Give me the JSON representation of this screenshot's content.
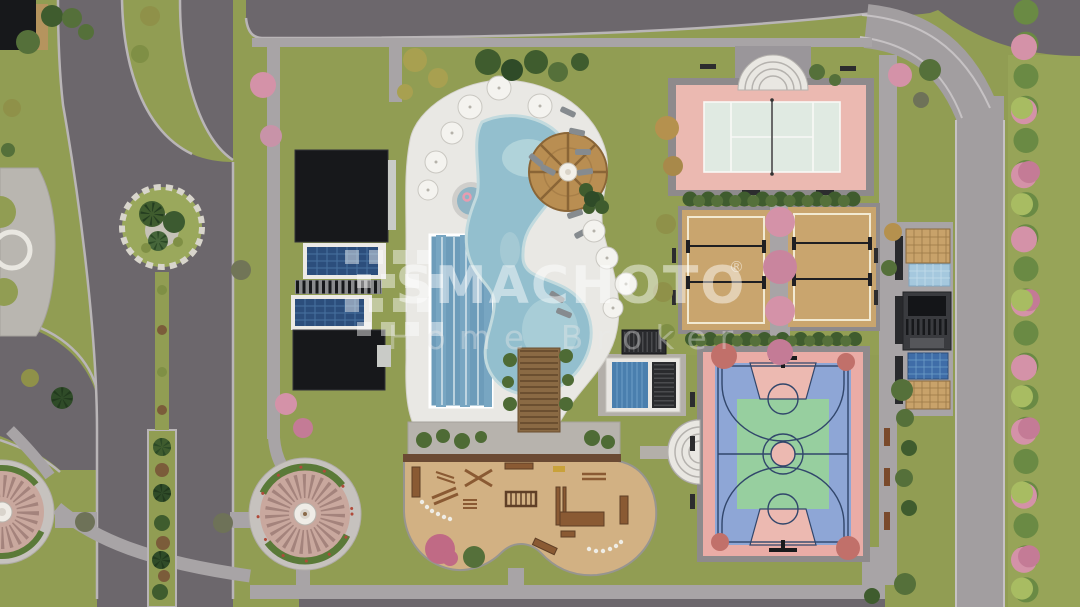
{
  "watermark": {
    "brand": "SMACHOTO",
    "registered": "®",
    "tagline": "Home Broker"
  },
  "colors": {
    "grass": "#919d53",
    "grass_light": "#97a458",
    "road_dark": "#6c676c",
    "road_light": "#a29ea0",
    "path": "#a8a4a6",
    "curb": "#b9b5b7",
    "deck": "#e9e8e4",
    "pool_water": "#93bfce",
    "pool_light": "#bad9de",
    "lap_water": "#6d9cba",
    "sand": "#c9a56e",
    "sand_line": "#f2ead2",
    "tennis_pink": "#ebb9b1",
    "tennis_surface": "#e0eae2",
    "line_white": "#f8f8f6",
    "bball_pink": "#eaaca6",
    "bball_blue": "#8ea6d6",
    "bball_green": "#97cf9f",
    "bball_key": "#ecb9b1",
    "bball_line": "#31466b",
    "roof_black": "#17181b",
    "solar_blue": "#2c4e7c",
    "frame_white": "#eceae6",
    "kiosk_tan": "#c8a26a",
    "kiosk_blue": "#a5c8de",
    "kiosk_dark": "#3a3b3f",
    "gazebo": "#b98e52",
    "terrace": "#b7b3ad",
    "wood": "#8a6a44",
    "playground_sand": "#d2b183",
    "equipment": "#8a5a33",
    "plaza_ring": "#c6c2be",
    "plaza_paving": "#c9a89e",
    "fountain": "#efece6",
    "tree_dark": "#3f5c2e",
    "tree_green": "#55703a",
    "tree_light": "#a8bc62",
    "tree_olive": "#8f9149",
    "tree_pink": "#d492a8",
    "tree_pink_deep": "#c47b96",
    "tree_tan": "#b5914e",
    "shrub_brown": "#7b5c3a",
    "tree_gray": "#6e7258",
    "watermark_white": "#ffffff"
  },
  "features": {
    "tennis_court": "tennis court",
    "beach_volleyball_courts": "beach volleyball courts",
    "basketball_court": "basketball court",
    "free_form_pool": "free-form swimming pool",
    "lap_pool": "lap pool",
    "kids_pool": "kids pool",
    "pool_gazebo": "round thatched pool gazebo",
    "sun_umbrellas": "sun umbrellas",
    "sun_loungers": "sun loungers",
    "solar_roof_buildings": "flat-roof buildings with solar panels",
    "garden_pavilions": "garden pavilions",
    "pergola_walkway": "wooden pergola walkway",
    "outdoor_gym": "outdoor gym and playground",
    "fountain_plazas": "circular fountain plazas",
    "amphitheater_seats": "curved amphitheater seating",
    "palm_island": "palm tree traffic island",
    "roads": "internal roads",
    "footpaths": "footpaths",
    "ornamental_trees": "ornamental trees"
  }
}
